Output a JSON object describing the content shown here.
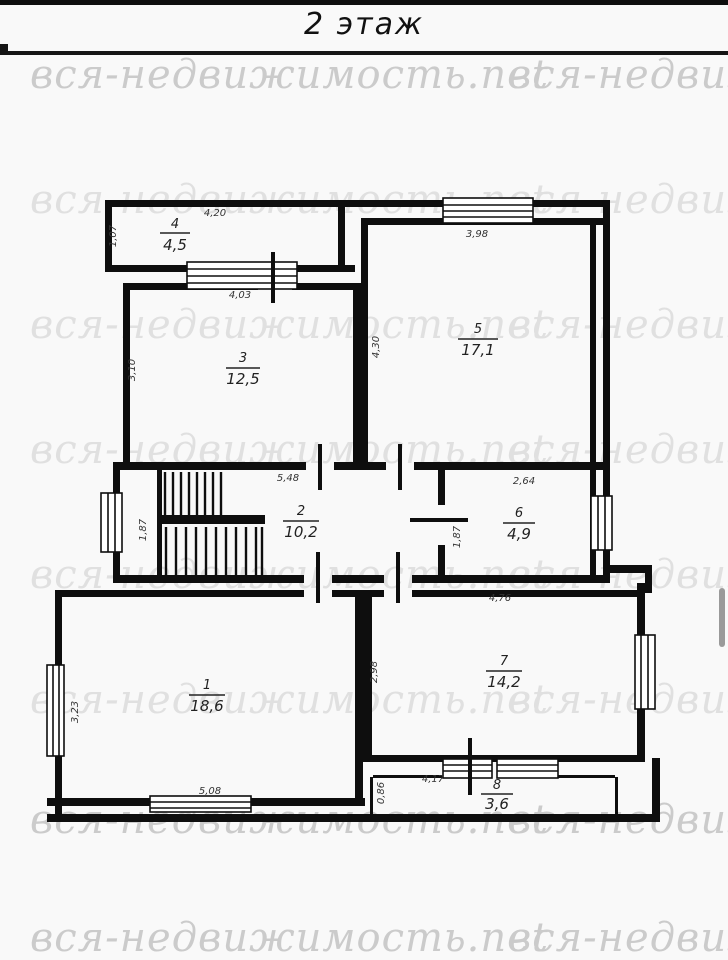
{
  "header": {
    "title": "2 этаж"
  },
  "watermark": {
    "text": "вся-недвижимость.net"
  },
  "rooms": [
    {
      "number": "1",
      "area": "18,6"
    },
    {
      "number": "2",
      "area": "10,2"
    },
    {
      "number": "3",
      "area": "12,5"
    },
    {
      "number": "4",
      "area": "4,5"
    },
    {
      "number": "5",
      "area": "17,1"
    },
    {
      "number": "6",
      "area": "4,9"
    },
    {
      "number": "7",
      "area": "14,2"
    },
    {
      "number": "8",
      "area": "3,6"
    }
  ],
  "dims": [
    "4,20",
    "1,07",
    "3,98",
    "4,30",
    "4,03",
    "3,10",
    "5,48",
    "1,87",
    "2,64",
    "1,87",
    "4,76",
    "2,98",
    "3,23",
    "5,08",
    "4,17",
    "0,86"
  ],
  "colors": {
    "wall": "#0e0e0e",
    "watermark_light": "#e0e0e0",
    "watermark_dark": "#cbcbcb",
    "scrollbar_thumb": "#9a9a9a"
  }
}
